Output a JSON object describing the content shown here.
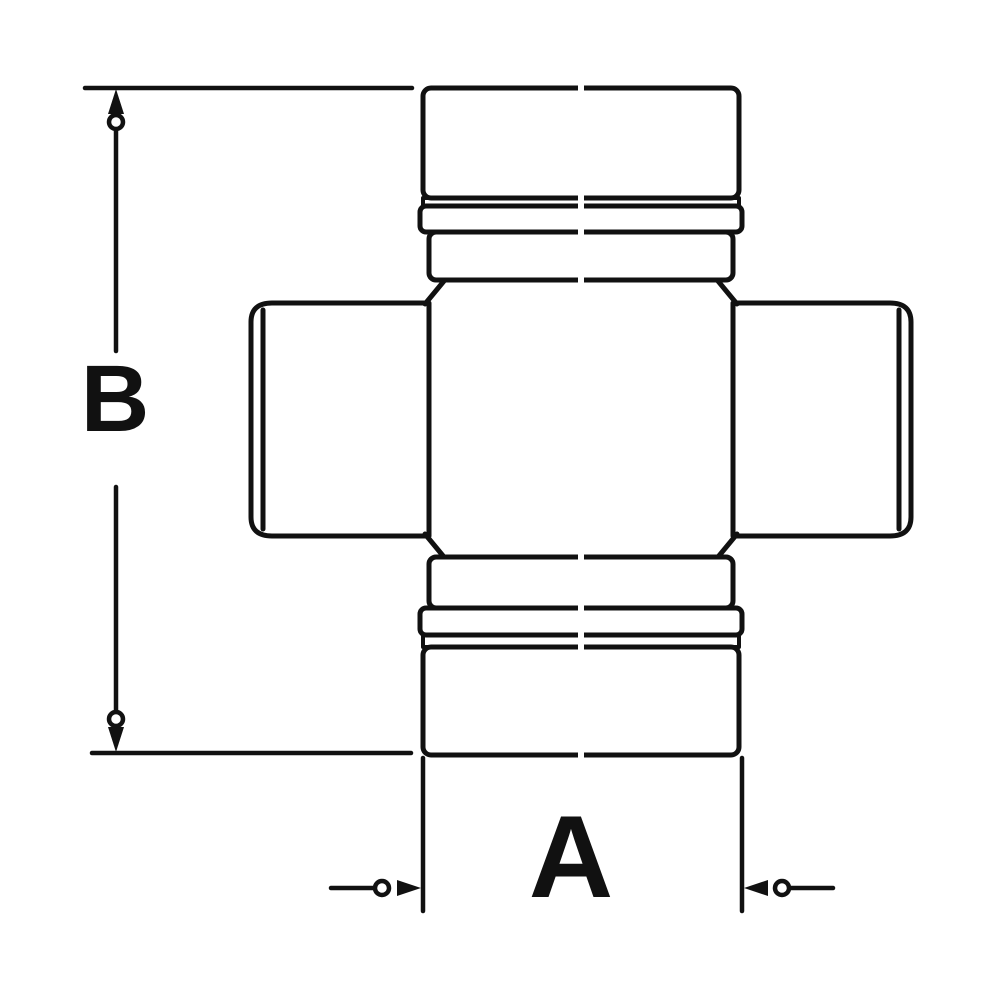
{
  "diagram": {
    "labels": {
      "width_dimension": "A",
      "height_dimension": "B"
    },
    "colors": {
      "line": "#111111",
      "background": "#ffffff"
    }
  }
}
